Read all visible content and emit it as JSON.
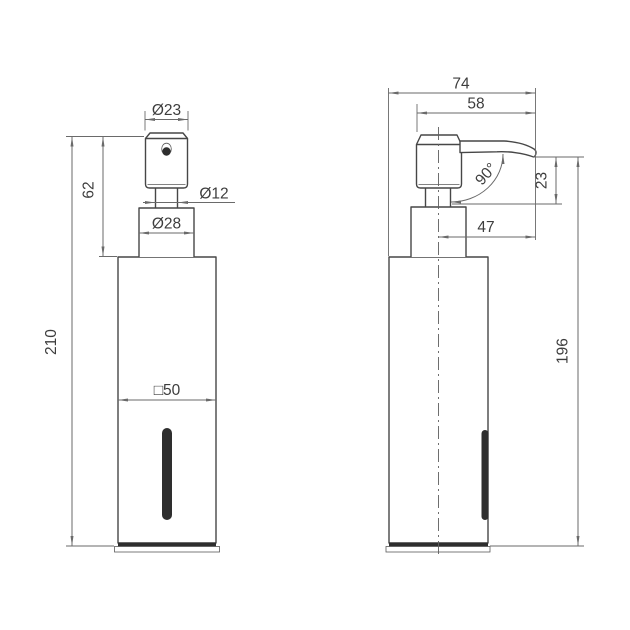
{
  "colors": {
    "background": "#ffffff",
    "outline": "#474747",
    "dimension_line": "#6a6a6a",
    "dimension_text": "#3d3d3d",
    "slot_fill": "#2e2e2e"
  },
  "front_view": {
    "dimensions": {
      "head_diameter": "Ø23",
      "pump_height": "62",
      "stem_diameter": "Ø12",
      "collar_diameter": "Ø28",
      "overall_height": "210",
      "body_width": "□50"
    }
  },
  "side_view": {
    "dimensions": {
      "overall_depth": "74",
      "head_to_spout": "58",
      "spout_angle": "90°",
      "spout_drop": "23",
      "spout_reach": "47",
      "body_height": "196"
    }
  }
}
